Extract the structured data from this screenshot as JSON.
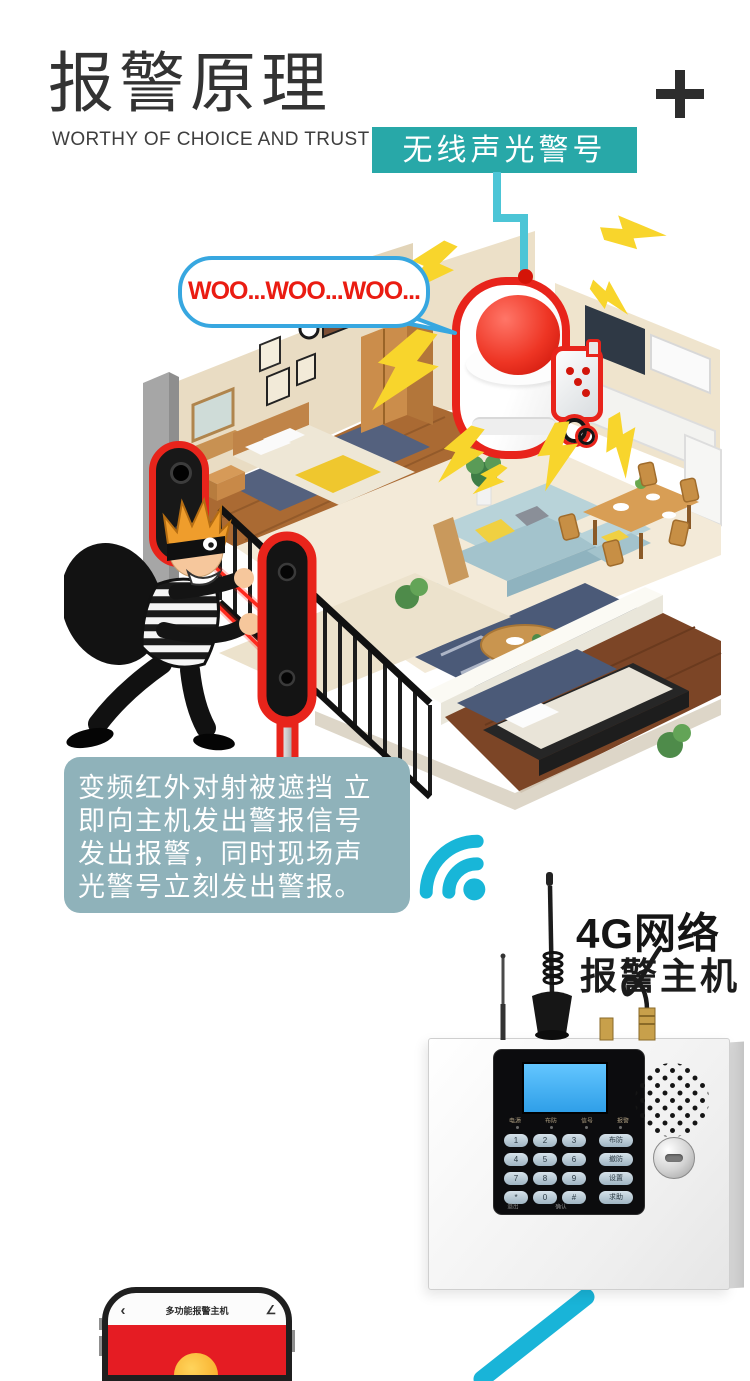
{
  "header": {
    "title": "报警原理",
    "subtitle": "WORTHY OF CHOICE AND TRUST"
  },
  "banner": {
    "label": "无线声光警号"
  },
  "speech_bubble": {
    "text": "WOO...WOO...WOO..."
  },
  "info_box": {
    "text": "变频红外对射被遮挡 立\n即向主机发出警报信号\n发出报警，同时现场声\n光警号立刻发出警报。"
  },
  "network": {
    "line1": "4G网络",
    "line2": "报警主机"
  },
  "host_panel": {
    "indicators": [
      "电源",
      "布防",
      "信号",
      "报警"
    ],
    "keys": [
      "1",
      "2",
      "3",
      "4",
      "5",
      "6",
      "7",
      "8",
      "9",
      "*",
      "0",
      "#"
    ],
    "function_keys": [
      "布防",
      "撤防",
      "设置",
      "求助"
    ],
    "bottom_labels": [
      "退出",
      "确认"
    ]
  },
  "phone": {
    "app_title": "多功能报警主机",
    "back_icon": "‹",
    "edit_icon": "∠"
  },
  "icons": {
    "plus": "+",
    "wifi": "signal-arcs",
    "lightning": "alarm-flash-bolt"
  },
  "colors": {
    "teal_banner": "#28a8a8",
    "cyan_accent": "#2ab9d8",
    "alert_red": "#e8241b",
    "bolt_yellow": "#f8d52c",
    "info_box_bg": "#8fb2ba",
    "bubble_border": "#37a7e0",
    "bubble_text": "#ea1c12"
  }
}
